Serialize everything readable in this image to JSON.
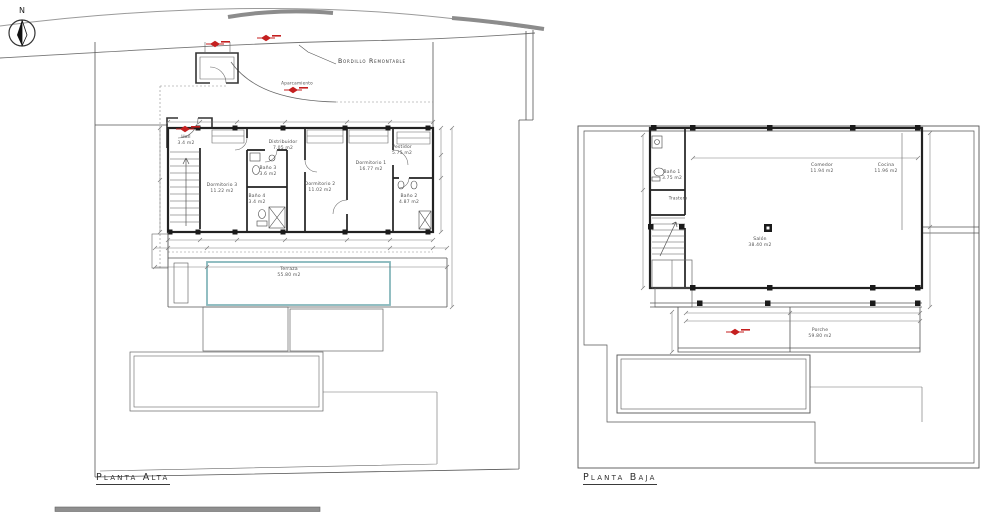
{
  "compass": {
    "north": "N"
  },
  "annotations": {
    "bordillo": "Bordillo Remontable",
    "aparcamiento": "Aparcamiento"
  },
  "planta_alta": {
    "title": "Planta Alta",
    "rooms": [
      {
        "name": "Hall",
        "area": "3.4 m2"
      },
      {
        "name": "Distribuidor",
        "area": "7.05 m2"
      },
      {
        "name": "Dormitorio 3",
        "area": "11.22 m2"
      },
      {
        "name": "Baño 3",
        "area": "3.6 m2"
      },
      {
        "name": "Baño 4",
        "area": "3.4 m2"
      },
      {
        "name": "Dormitorio 2",
        "area": "11.02 m2"
      },
      {
        "name": "Dormitorio 1",
        "area": "16.77 m2"
      },
      {
        "name": "Vestidor",
        "area": "5.75 m2"
      },
      {
        "name": "Baño 2",
        "area": "4.87 m2"
      },
      {
        "name": "Terraza",
        "area": "55.80 m2"
      }
    ]
  },
  "planta_baja": {
    "title": "Planta Baja",
    "rooms": [
      {
        "name": "Baño 1",
        "area": "3.75 m2"
      },
      {
        "name": "Trastero",
        "area": ""
      },
      {
        "name": "Comedor",
        "area": "11.94 m2"
      },
      {
        "name": "Cocina",
        "area": "11.96 m2"
      },
      {
        "name": "Salón",
        "area": "38.40 m2"
      },
      {
        "name": "Porche",
        "area": "59.80 m2"
      }
    ]
  }
}
